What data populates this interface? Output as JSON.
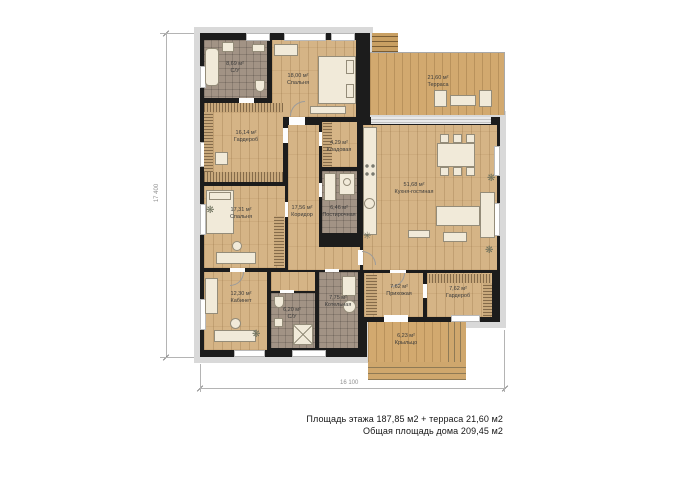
{
  "plan": {
    "rooms": [
      {
        "id": "su-top",
        "area": "8,69 м²",
        "name": "С/У"
      },
      {
        "id": "bedroom-top",
        "area": "18,00 м²",
        "name": "Спальня"
      },
      {
        "id": "terrace",
        "area": "21,60 м²",
        "name": "Терраса"
      },
      {
        "id": "wardrobe-left",
        "area": "16,14 м²",
        "name": "Гардероб"
      },
      {
        "id": "storage",
        "area": "4,29 м²",
        "name": "Кладовая"
      },
      {
        "id": "corridor",
        "area": "17,56 м²",
        "name": "Коридор"
      },
      {
        "id": "laundry",
        "area": "6,46 м²",
        "name": "Постирочная"
      },
      {
        "id": "kitchen-living",
        "area": "51,68 м²",
        "name": "Кухня-гостиная"
      },
      {
        "id": "bedroom-left",
        "area": "17,31 м²",
        "name": "Спальня"
      },
      {
        "id": "office",
        "area": "12,30 м²",
        "name": "Кабинет"
      },
      {
        "id": "su-bottom",
        "area": "6,20 м²",
        "name": "С/У"
      },
      {
        "id": "boiler",
        "area": "7,75 м²",
        "name": "Котельная"
      },
      {
        "id": "hallway",
        "area": "7,62 м²",
        "name": "Прихожая"
      },
      {
        "id": "wardrobe-right",
        "area": "7,62 м²",
        "name": "Гардероб"
      },
      {
        "id": "porch",
        "area": "6,23 м²",
        "name": "Крыльцо"
      }
    ],
    "dimensions": {
      "bottom": "16 100",
      "left": "17 400"
    },
    "summary": {
      "line1": "Площадь этажа 187,85 м2 + терраса 21,60 м2",
      "line2": "Общая площадь дома 209,45 м2"
    },
    "colors": {
      "wall": "#1c1c1c",
      "wood_floor": "#d5b486",
      "terrace_floor": "#d2a96f",
      "tile_floor": "#a29385",
      "facade_trim": "#d9d9d9",
      "furniture": "#f1ead9"
    }
  }
}
